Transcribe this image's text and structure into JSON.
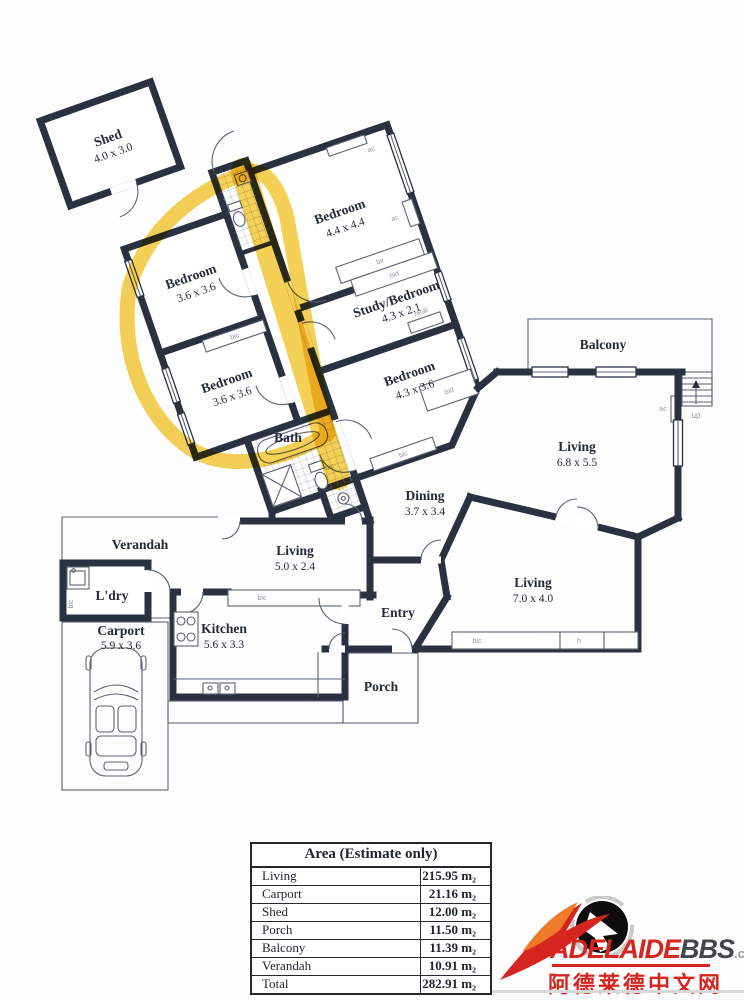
{
  "floorplan": {
    "rooms": {
      "shed": {
        "name": "Shed",
        "dims": "4.0 x 3.0"
      },
      "bedroom_main": {
        "name": "Bedroom",
        "dims": "4.4 x 4.4"
      },
      "bedroom_left_top": {
        "name": "Bedroom",
        "dims": "3.6 x 3.6"
      },
      "bedroom_left_bottom": {
        "name": "Bedroom",
        "dims": "3.6 x 3.6"
      },
      "study": {
        "name": "Study/Bedroom",
        "dims": "4.3 x 2.1"
      },
      "bedroom_mid": {
        "name": "Bedroom",
        "dims": "4.3 x 3.6"
      },
      "bath": {
        "name": "Bath"
      },
      "balcony": {
        "name": "Balcony"
      },
      "living_upper": {
        "name": "Living",
        "dims": "6.8 x 5.5"
      },
      "dining": {
        "name": "Dining",
        "dims": "3.7 x 3.4"
      },
      "living_mid": {
        "name": "Living",
        "dims": "5.0 x 2.4"
      },
      "living_lower": {
        "name": "Living",
        "dims": "7.0 x 4.0"
      },
      "entry": {
        "name": "Entry"
      },
      "kitchen": {
        "name": "Kitchen",
        "dims": "5.6 x 3.3"
      },
      "verandah": {
        "name": "Verandah"
      },
      "laundry": {
        "name": "L'dry"
      },
      "carport": {
        "name": "Carport",
        "dims": "5.9 x 3.6"
      },
      "porch": {
        "name": "Porch"
      }
    },
    "annotations": {
      "ac": "ac",
      "bic": "bic",
      "bir": "bir",
      "bid": "bid",
      "heat": "heat",
      "h": "h",
      "up": "up"
    },
    "highlight_color": "#f3c52c"
  },
  "area_table": {
    "title": "Area (Estimate only)",
    "rows": [
      {
        "label": "Living",
        "value": "215.95 m₂"
      },
      {
        "label": "Carport",
        "value": "21.16 m₂"
      },
      {
        "label": "Shed",
        "value": "12.00 m₂"
      },
      {
        "label": "Porch",
        "value": "11.50 m₂"
      },
      {
        "label": "Balcony",
        "value": "11.39 m₂"
      },
      {
        "label": "Verandah",
        "value": "10.91 m₂"
      },
      {
        "label": "Total",
        "value": "282.91 m₂"
      }
    ]
  },
  "watermark": {
    "brand": "ADELAIDE",
    "brand_bold": "BBS",
    "brand_tld": ".com",
    "tagline_cn": "阿德莱德中文网"
  }
}
